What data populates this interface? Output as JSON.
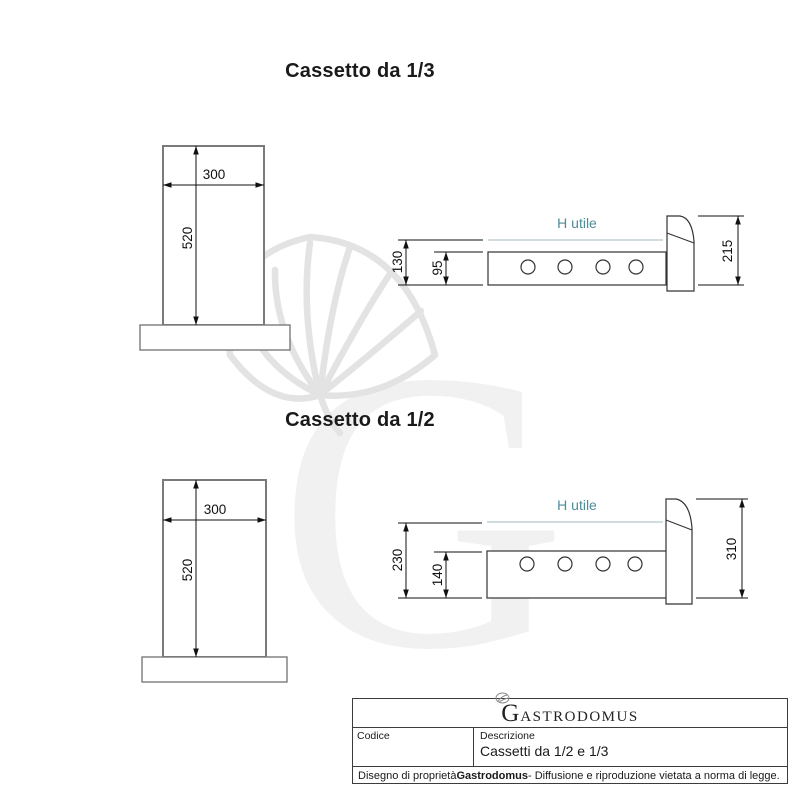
{
  "sections": [
    {
      "title": "Cassetto da 1/3",
      "front_view": {
        "width": "300",
        "height": "520"
      },
      "side_view": {
        "h_utile": "H utile",
        "dim_total_height": "130",
        "dim_body_height": "95",
        "dim_front_height": "215",
        "hole_count": 4
      }
    },
    {
      "title": "Cassetto da 1/2",
      "front_view": {
        "width": "300",
        "height": "520"
      },
      "side_view": {
        "h_utile": "H utile",
        "dim_total_height": "230",
        "dim_body_height": "140",
        "dim_front_height": "310",
        "hole_count": 4
      }
    }
  ],
  "watermark": {
    "letter": "G"
  },
  "title_block": {
    "logo_initial": "G",
    "logo_rest": "ASTRODOMUS",
    "codice_label": "Codice",
    "descrizione_label": "Descrizione",
    "descrizione_value": "Cassetti da 1/2 e 1/3",
    "footer": {
      "prefix": "Disegno di proprietà ",
      "brand": "Gastrodomus",
      "suffix": " - Diffusione e riproduzione vietata a norma di legge."
    }
  },
  "colors": {
    "h_utile_text": "#4d8d99",
    "h_utile_line": "#b3c8cc",
    "drawing_outline": "#7a7a7a",
    "dimension_lines": "#111111",
    "watermark_letter": "#f1f1f1",
    "watermark_hat": "#e3e3e3"
  }
}
